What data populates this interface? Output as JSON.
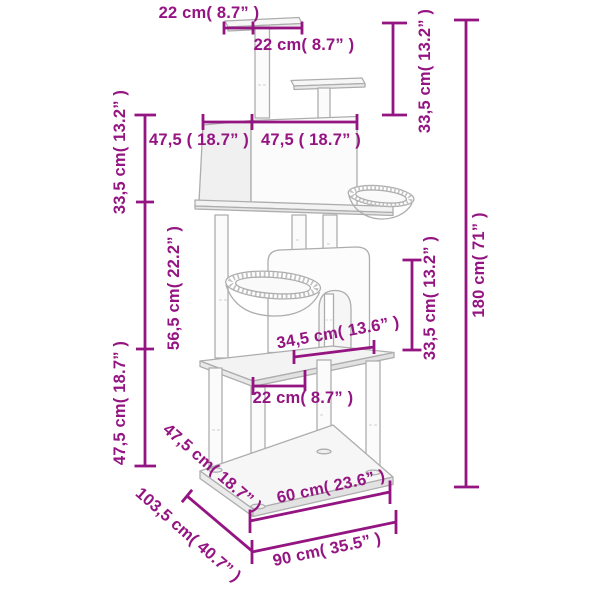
{
  "canvas": {
    "width": "600",
    "height": "600",
    "background": "#ffffff"
  },
  "style": {
    "dimension_color": "#941482",
    "artwork_line_color": "#ADADAD"
  },
  "dims": {
    "top_plate_depth": {
      "text": "22 cm( 8.7” )"
    },
    "top_plate_width": {
      "text": "22 cm( 8.7” )"
    },
    "condo_depth": {
      "text": "47,5 ( 18.7” )"
    },
    "condo_width": {
      "text": "47,5 ( 18.7” )"
    },
    "top_section_height": {
      "text": "33,5 cm( 13.2” )"
    },
    "upper_left_height": {
      "text": "33,5 cm( 13.2” )"
    },
    "middle_left_height": {
      "text": "56,5 cm( 22.2” )"
    },
    "lower_left_height": {
      "text": "47,5 cm( 18.7” )"
    },
    "total_height": {
      "text": "180 cm( 71” )"
    },
    "middle_right_height": {
      "text": "33,5 cm( 13.2” )"
    },
    "platform_width": {
      "text": "34,5 cm( 13.6” )"
    },
    "platform_front": {
      "text": "22 cm( 8.7” )"
    },
    "base_side_edge": {
      "text": "47,5 cm( 18.7” )"
    },
    "base_diagonal": {
      "text": "103,5 cm( 40.7” )"
    },
    "base_depth": {
      "text": "60 cm( 23.6” )"
    },
    "base_width": {
      "text": "90 cm( 35.5” )"
    }
  }
}
